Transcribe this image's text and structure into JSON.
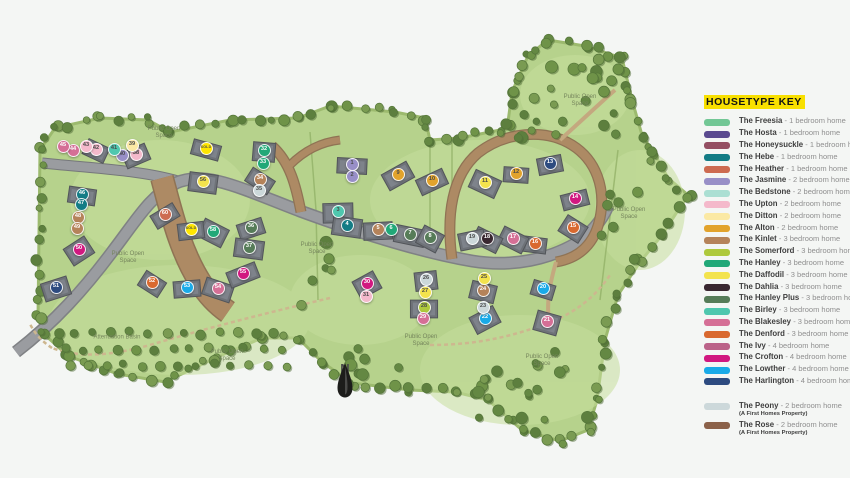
{
  "housetype_colors": {
    "freesia": "#72c795",
    "hosta": "#5a4a8f",
    "honeysuckle": "#944f62",
    "hebe": "#137c85",
    "heather": "#cd6b51",
    "jasmine": "#988fc7",
    "bedstone": "#abdfd3",
    "upton": "#f4b9cb",
    "ditton": "#fbe9a4",
    "alton": "#e2a32c",
    "kinlet": "#b5835a",
    "somerford": "#aec93c",
    "hanley": "#21a878",
    "daffodil": "#f3e34d",
    "dahlia": "#392730",
    "hanley_plus": "#567c58",
    "birley": "#4fc7ae",
    "blakesley": "#d56f96",
    "denford": "#d9692f",
    "ivy": "#bb6389",
    "crofton": "#d11880",
    "lowther": "#19aae8",
    "harlington": "#2d4b80",
    "peony": "#ccd8da",
    "rose": "#8b6149",
    "sold": "#ffe600"
  },
  "legend": {
    "title": "HOUSETYPE KEY",
    "items": [
      {
        "name": "The Freesia",
        "desc": "- 1 bedroom home",
        "type": "freesia"
      },
      {
        "name": "The Hosta",
        "desc": "- 1 bedroom home",
        "type": "hosta"
      },
      {
        "name": "The Honeysuckle",
        "desc": "- 1 bedroom home",
        "type": "honeysuckle"
      },
      {
        "name": "The Hebe",
        "desc": "- 1 bedroom home",
        "type": "hebe"
      },
      {
        "name": "The Heather",
        "desc": "- 1 bedroom home",
        "type": "heather"
      },
      {
        "name": "The Jasmine",
        "desc": "- 2 bedroom home",
        "type": "jasmine"
      },
      {
        "name": "The Bedstone",
        "desc": "- 2 bedroom home",
        "type": "bedstone"
      },
      {
        "name": "The Upton",
        "desc": "- 2 bedroom home",
        "type": "upton"
      },
      {
        "name": "The Ditton",
        "desc": "- 2 bedroom home",
        "type": "ditton"
      },
      {
        "name": "The Alton",
        "desc": "- 2 bedroom home",
        "type": "alton"
      },
      {
        "name": "The Kinlet",
        "desc": "- 3 bedroom home",
        "type": "kinlet"
      },
      {
        "name": "The Somerford",
        "desc": "- 3 bedroom home",
        "type": "somerford"
      },
      {
        "name": "The Hanley",
        "desc": "- 3 bedroom home",
        "type": "hanley"
      },
      {
        "name": "The Daffodil",
        "desc": "- 3 bedroom home",
        "type": "daffodil"
      },
      {
        "name": "The Dahlia",
        "desc": "- 3 bedroom home",
        "type": "dahlia"
      },
      {
        "name": "The Hanley Plus",
        "desc": "- 3 bedroom home",
        "type": "hanley_plus"
      },
      {
        "name": "The Birley",
        "desc": "- 3 bedroom home",
        "type": "birley"
      },
      {
        "name": "The Blakesley",
        "desc": "- 3 bedroom home",
        "type": "blakesley"
      },
      {
        "name": "The Denford",
        "desc": "- 3 bedroom home",
        "type": "denford"
      },
      {
        "name": "The Ivy",
        "desc": "- 4 bedroom home",
        "type": "ivy"
      },
      {
        "name": "The Crofton",
        "desc": "- 4 bedroom home",
        "type": "crofton"
      },
      {
        "name": "The Lowther",
        "desc": "- 4 bedroom home",
        "type": "lowther"
      },
      {
        "name": "The Harlington",
        "desc": "- 4 bedroom home",
        "type": "harlington"
      }
    ],
    "first_homes": [
      {
        "name": "The Peony",
        "desc": "- 2 bedroom home",
        "note": "(A First Homes Property)",
        "type": "peony"
      },
      {
        "name": "The Rose",
        "desc": "- 2 bedroom home",
        "note": "(A First Homes Property)",
        "type": "rose"
      }
    ]
  },
  "map": {
    "compass_label": "N",
    "labels": [
      {
        "text": "Public Open Space",
        "x": 164,
        "y": 133
      },
      {
        "text": "Public Open Space",
        "x": 580,
        "y": 101
      },
      {
        "text": "Public Open Space",
        "x": 128,
        "y": 258
      },
      {
        "text": "Public Open Space",
        "x": 317,
        "y": 249
      },
      {
        "text": "Public Open Space",
        "x": 629,
        "y": 214
      },
      {
        "text": "Public Open Space",
        "x": 227,
        "y": 356
      },
      {
        "text": "Public Open Space",
        "x": 421,
        "y": 341
      },
      {
        "text": "Public Open Space",
        "x": 542,
        "y": 361
      },
      {
        "text": "Attenuation Basin",
        "x": 117,
        "y": 338,
        "wide": true
      }
    ],
    "plots": [
      {
        "num": "1",
        "type": "jasmine",
        "x": 352,
        "y": 164
      },
      {
        "num": "2",
        "type": "jasmine",
        "x": 352,
        "y": 176
      },
      {
        "num": "3",
        "type": "birley",
        "x": 338,
        "y": 211
      },
      {
        "num": "4",
        "type": "hebe",
        "x": 347,
        "y": 225
      },
      {
        "num": "5",
        "type": "kinlet",
        "x": 378,
        "y": 229
      },
      {
        "num": "6",
        "type": "hanley",
        "x": 391,
        "y": 229
      },
      {
        "num": "7",
        "type": "hanley_plus",
        "x": 410,
        "y": 234
      },
      {
        "num": "8",
        "type": "hanley_plus",
        "x": 430,
        "y": 237
      },
      {
        "num": "9",
        "type": "alton",
        "x": 398,
        "y": 174
      },
      {
        "num": "10",
        "type": "alton",
        "x": 432,
        "y": 180
      },
      {
        "num": "11",
        "type": "daffodil",
        "x": 485,
        "y": 182
      },
      {
        "num": "12",
        "type": "alton",
        "x": 516,
        "y": 173
      },
      {
        "num": "13",
        "type": "harlington",
        "x": 550,
        "y": 163
      },
      {
        "num": "14",
        "type": "crofton",
        "x": 575,
        "y": 198
      },
      {
        "num": "15",
        "type": "denford",
        "x": 573,
        "y": 227
      },
      {
        "num": "16",
        "type": "denford",
        "x": 535,
        "y": 243
      },
      {
        "num": "17",
        "type": "blakesley",
        "x": 513,
        "y": 238
      },
      {
        "num": "18",
        "type": "dahlia",
        "x": 487,
        "y": 238
      },
      {
        "num": "19",
        "type": "peony",
        "x": 472,
        "y": 238
      },
      {
        "num": "20",
        "type": "lowther",
        "x": 543,
        "y": 288
      },
      {
        "num": "21",
        "type": "blakesley",
        "x": 547,
        "y": 321
      },
      {
        "num": "22",
        "type": "lowther",
        "x": 485,
        "y": 318
      },
      {
        "num": "23",
        "type": "peony",
        "x": 483,
        "y": 307
      },
      {
        "num": "24",
        "type": "kinlet",
        "x": 483,
        "y": 290
      },
      {
        "num": "25",
        "type": "daffodil",
        "x": 484,
        "y": 278
      },
      {
        "num": "26",
        "type": "peony",
        "x": 426,
        "y": 279
      },
      {
        "num": "27",
        "type": "daffodil",
        "x": 425,
        "y": 292
      },
      {
        "num": "28",
        "type": "somerford",
        "x": 424,
        "y": 307
      },
      {
        "num": "29",
        "type": "blakesley",
        "x": 423,
        "y": 318
      },
      {
        "num": "30",
        "type": "crofton",
        "x": 367,
        "y": 283
      },
      {
        "num": "31",
        "type": "upton",
        "x": 366,
        "y": 296
      },
      {
        "num": "32",
        "type": "hanley",
        "x": 264,
        "y": 150
      },
      {
        "num": "33",
        "type": "hanley",
        "x": 263,
        "y": 163
      },
      {
        "num": "34",
        "type": "kinlet",
        "x": 260,
        "y": 179
      },
      {
        "num": "35",
        "type": "peony",
        "x": 259,
        "y": 190
      },
      {
        "num": "36",
        "type": "hanley_plus",
        "x": 251,
        "y": 227
      },
      {
        "num": "37",
        "type": "hanley_plus",
        "x": 249,
        "y": 247
      },
      {
        "num": "38",
        "type": "upton",
        "x": 136,
        "y": 154
      },
      {
        "num": "39",
        "type": "ditton",
        "x": 132,
        "y": 145
      },
      {
        "num": "40",
        "type": "jasmine",
        "x": 122,
        "y": 155
      },
      {
        "num": "41",
        "type": "birley",
        "x": 114,
        "y": 149
      },
      {
        "num": "42",
        "type": "upton",
        "x": 96,
        "y": 149
      },
      {
        "num": "43",
        "type": "upton",
        "x": 86,
        "y": 146
      },
      {
        "num": "44",
        "type": "blakesley",
        "x": 73,
        "y": 150
      },
      {
        "num": "45",
        "type": "blakesley",
        "x": 63,
        "y": 146
      },
      {
        "num": "46",
        "type": "hebe",
        "x": 82,
        "y": 194
      },
      {
        "num": "47",
        "type": "hebe",
        "x": 81,
        "y": 204
      },
      {
        "num": "48",
        "type": "kinlet",
        "x": 78,
        "y": 217
      },
      {
        "num": "49",
        "type": "kinlet",
        "x": 77,
        "y": 228
      },
      {
        "num": "50",
        "type": "crofton",
        "x": 79,
        "y": 249
      },
      {
        "num": "51",
        "type": "harlington",
        "x": 56,
        "y": 287
      },
      {
        "num": "52",
        "type": "denford",
        "x": 152,
        "y": 282
      },
      {
        "num": "53",
        "type": "lowther",
        "x": 187,
        "y": 287
      },
      {
        "num": "54",
        "type": "blakesley",
        "x": 218,
        "y": 288
      },
      {
        "num": "55",
        "type": "crofton",
        "x": 243,
        "y": 273
      },
      {
        "num": "56",
        "type": "daffodil",
        "x": 203,
        "y": 181
      },
      {
        "num": "SOLD",
        "type": "sold",
        "x": 206,
        "y": 148
      },
      {
        "num": "58",
        "type": "hanley",
        "x": 213,
        "y": 231
      },
      {
        "num": "SOLD",
        "type": "sold",
        "x": 191,
        "y": 229
      },
      {
        "num": "60",
        "type": "heather",
        "x": 165,
        "y": 214
      }
    ]
  }
}
